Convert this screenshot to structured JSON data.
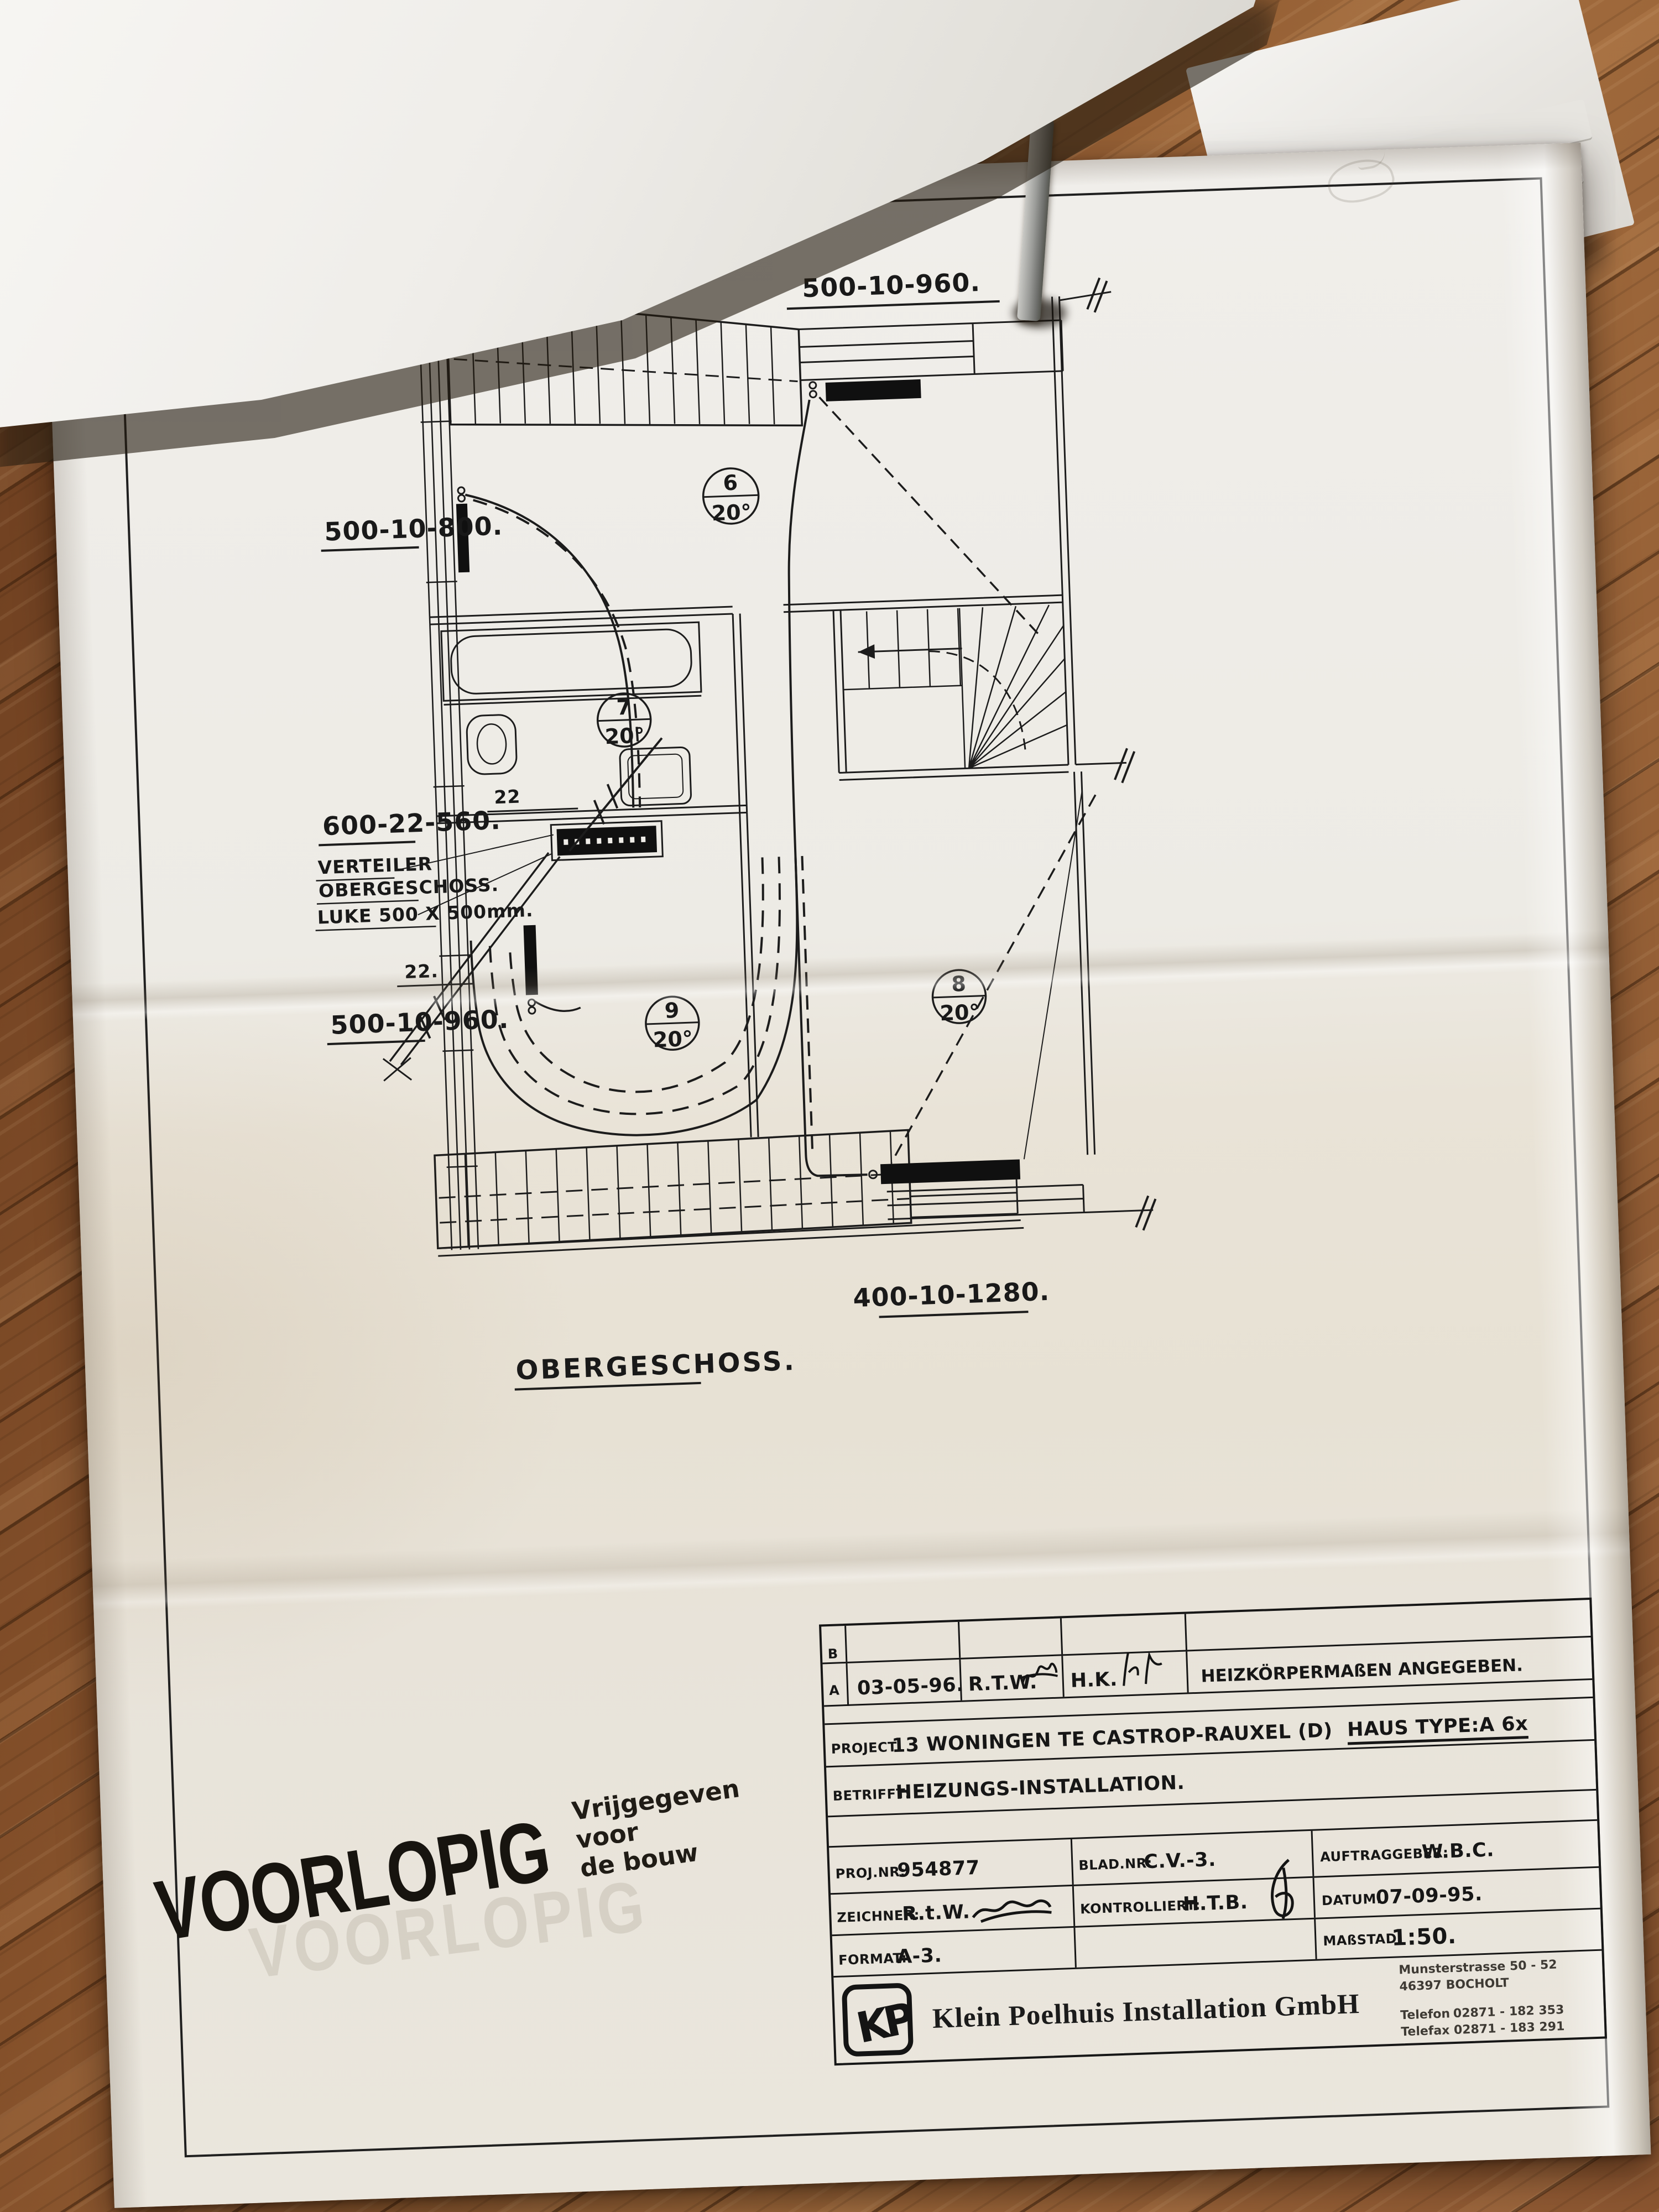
{
  "plan": {
    "dim_top": "500-10-960.",
    "dim_left": "500-10-800.",
    "dim_mid": "600-22-560.",
    "verteiler_line1": "VERTEILER",
    "verteiler_line2": "OBERGESCHOSS.",
    "luke": "LUKE 500 X 500mm.",
    "dim_lower_left": "500-10-960.",
    "dim_bottom": "400-10-1280.",
    "pipe_size_upper": "22",
    "pipe_size_lower": "22.",
    "floor_title": "OBERGESCHOSS.",
    "rooms": [
      {
        "number": "6",
        "temp": "20°"
      },
      {
        "number": "7",
        "temp": "20°"
      },
      {
        "number": "8",
        "temp": "20°"
      },
      {
        "number": "9",
        "temp": "20°"
      }
    ]
  },
  "title_block": {
    "revisions": [
      {
        "marker": "B",
        "date": "",
        "drawn": "",
        "checked": "",
        "note": ""
      },
      {
        "marker": "A",
        "date": "03-05-96.",
        "drawn": "R.T.W.",
        "checked": "H.K.",
        "note": "HEIZKÖRPERMAßEN ANGEGEBEN."
      }
    ],
    "project_label": "PROJECT:",
    "project_value": "13 WONINGEN TE CASTROP-RAUXEL (D)",
    "haus_type": "HAUS TYPE:A  6x",
    "betrifft_label": "BETRIFFT:",
    "betrifft_value": "HEIZUNGS-INSTALLATION.",
    "projnr_label": "PROJ.NR:",
    "projnr_value": "954877",
    "bladnr_label": "BLAD.NR:",
    "bladnr_value": "C.V.-3.",
    "auftraggeber_label": "AUFTRAGGEBER:",
    "auftraggeber_value": "W.B.C.",
    "zeichner_label": "ZEICHNER:",
    "zeichner_value": "R.t.W.",
    "kontrolliert_label": "KONTROLLIERT:",
    "kontrolliert_value": "H.T.B.",
    "datum_label": "DATUM:",
    "datum_value": "07-09-95.",
    "format_label": "FORMAT:",
    "format_value": "A-3.",
    "massstab_label": "MAßSTAD:",
    "massstab_value": "1:50."
  },
  "company": {
    "logo_monogram": "KP",
    "name": "Klein Poelhuis Installation GmbH",
    "address_line1": "Munsterstrasse 50 - 52",
    "address_line2": "46397 BOCHOLT",
    "telefon_label": "Telefon",
    "telefon_value": "02871 - 182 353",
    "telefax_label": "Telefax",
    "telefax_value": "02871 - 183 291"
  },
  "stamp": {
    "main": "VOORLOPIG",
    "sub_line1": "Vrijgegeven voor",
    "sub_line2": "de bouw",
    "ghost": "VOORLOPIG"
  },
  "colors": {
    "paper": "#edebe5",
    "ink": "#1a1a1a",
    "wood": "#8a5530"
  }
}
